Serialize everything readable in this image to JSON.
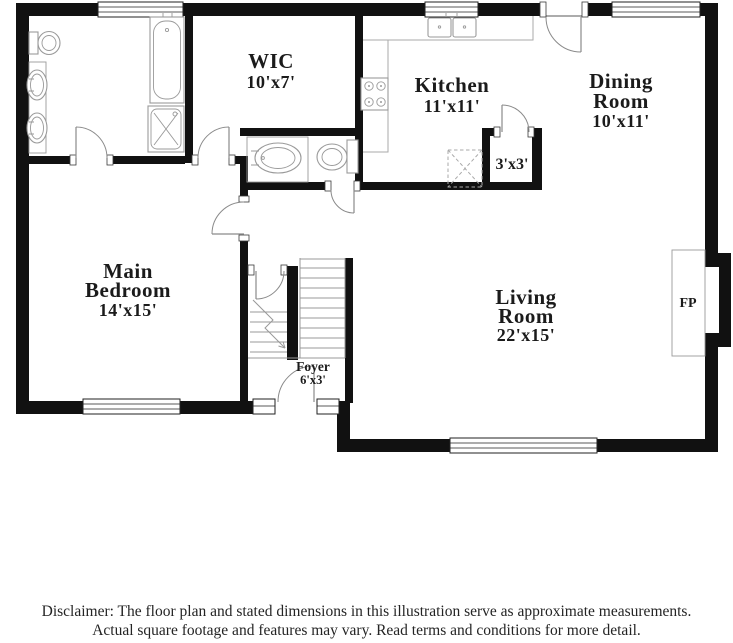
{
  "title": "Floor plan illustration",
  "colors": {
    "wall": "#111111",
    "fixture_outline": "#9a9a9a",
    "counter_outline": "#aaaaaa",
    "stair_outline": "#999999",
    "door_outline": "#8a8a8a",
    "label_text": "#1b1b1b",
    "background": "#ffffff"
  },
  "rooms": [
    {
      "id": "wic",
      "lines": [
        "WIC",
        "10'x7'"
      ]
    },
    {
      "id": "kitchen",
      "lines": [
        "Kitchen",
        "11'x11'"
      ]
    },
    {
      "id": "dining",
      "lines": [
        "Dining",
        "Room",
        "10'x11'"
      ]
    },
    {
      "id": "bedroom",
      "lines": [
        "Main",
        "Bedroom",
        "14'x15'"
      ]
    },
    {
      "id": "living",
      "lines": [
        "Living",
        "Room",
        "22'x15'"
      ]
    },
    {
      "id": "foyer",
      "lines": [
        "Foyer",
        "6'x3'"
      ]
    },
    {
      "id": "closet",
      "lines": [
        "3'x3'"
      ]
    },
    {
      "id": "fireplace",
      "lines": [
        "FP"
      ]
    }
  ],
  "features": {
    "windows": 5,
    "sidelights": 2,
    "doors": [
      "front-entry",
      "rear-entry",
      "main-bathroom",
      "wic",
      "main-bedroom",
      "half-bath",
      "closet",
      "basement-stairs"
    ],
    "fixtures": [
      "toilet",
      "double-vanity",
      "bathtub",
      "shower",
      "half-bath-sink",
      "half-bath-toilet",
      "kitchen-sink",
      "stove",
      "appliance-box",
      "fireplace-hearth"
    ],
    "stairs": [
      "stairs-up",
      "stairs-down"
    ]
  },
  "disclaimer": {
    "line1": "Disclaimer: The floor plan and stated dimensions in this illustration serve as approximate measurements.",
    "line2": "Actual square footage and features may vary. Read terms and conditions for more detail."
  }
}
